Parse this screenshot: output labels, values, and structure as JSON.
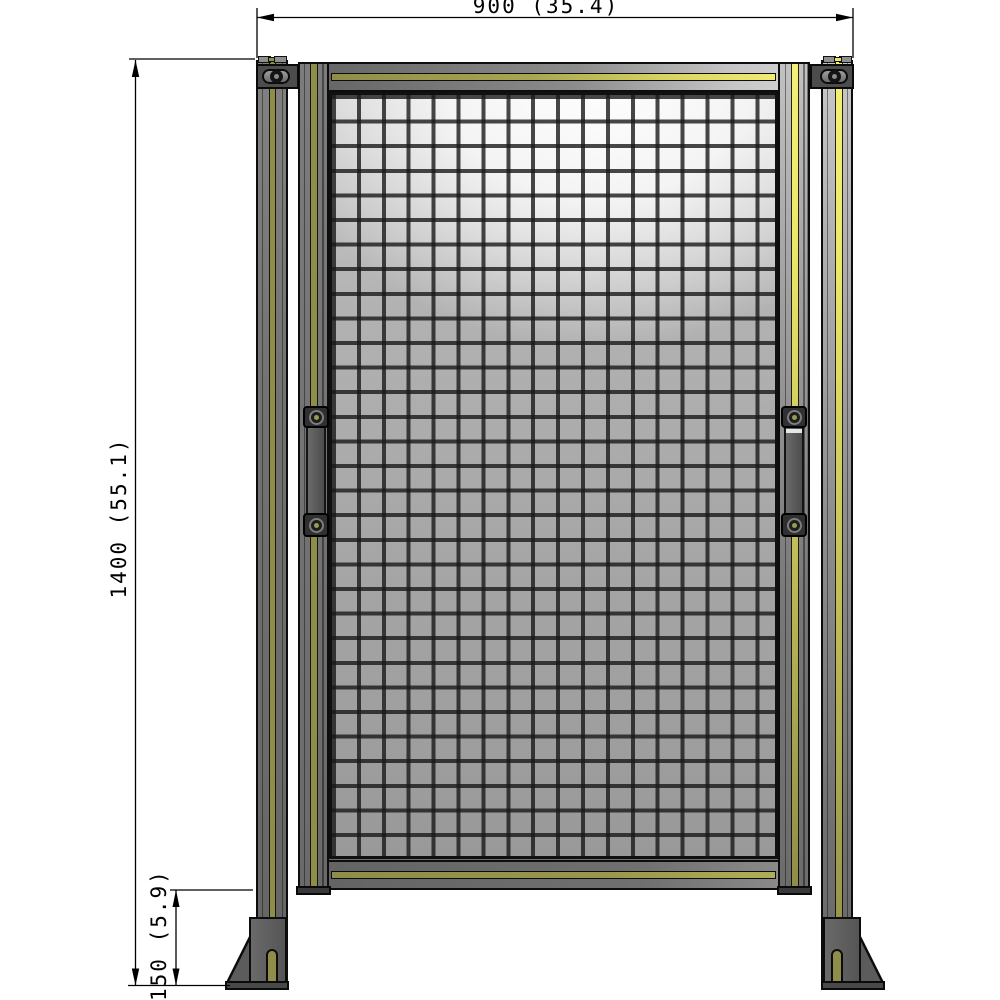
{
  "drawing": {
    "view": "front elevation of wire-mesh safety fence door panel with two floor posts",
    "dimensions": {
      "width": "900 (35.4)",
      "height": "1400 (55.1)",
      "foot_height": "150 (5.9)"
    },
    "mesh": {
      "columns": 18,
      "rows": 31
    },
    "colors": {
      "accent_yellow": "#eeea6e",
      "accent_olive": "#8e8e4a",
      "metal_gray": "#6f6f6f",
      "mesh_wire": "#2a2a2a",
      "outline": "#000000",
      "background": "#ffffff"
    }
  }
}
